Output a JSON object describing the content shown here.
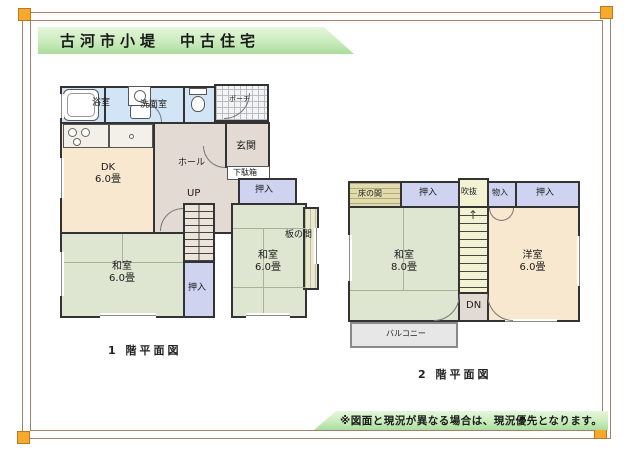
{
  "title_banner": {
    "text": "古河市小堤　中古住宅"
  },
  "footer_note": {
    "text": "※図面と現況が異なる場合は、現況優先となります。"
  },
  "floor1": {
    "caption": "1 階平面図",
    "bath": "浴室",
    "washroom": "洗面室",
    "porch": "ポーチ",
    "entrance": "玄関",
    "shoe_cabinet": "下駄箱",
    "hall": "ホール",
    "dk_label": "DK",
    "dk_size": "6.0畳",
    "up": "UP",
    "closet_right": "押入",
    "closet_center": "押入",
    "washitsu_left_label": "和室",
    "washitsu_left_size": "6.0畳",
    "washitsu_right_label": "和室",
    "washitsu_right_size": "6.0畳",
    "itanoma": "板の間"
  },
  "floor2": {
    "caption": "2 階平面図",
    "tokonoma": "床の間",
    "closet_left": "押入",
    "void": "吹抜",
    "storage": "物入",
    "closet_right": "押入",
    "washitsu_label": "和室",
    "washitsu_size": "8.0畳",
    "youshitsu_label": "洋室",
    "youshitsu_size": "6.0畳",
    "dn": "DN",
    "stairs_arrow": "↑",
    "balcony": "バルコニー"
  },
  "colors": {
    "tatami_green": "#dee5d0",
    "closet_lavender": "#cfd3f0",
    "wood_cream": "#f8e8d0",
    "hall_taupe": "#e3dbd3",
    "water_blue": "#d2e5f6",
    "stair_yellow": "#f3f3d4",
    "banner_green": "#aadd9c",
    "frame_brown": "#a2806d",
    "corner_orange": "#f6a92c",
    "wall": "#333333"
  }
}
